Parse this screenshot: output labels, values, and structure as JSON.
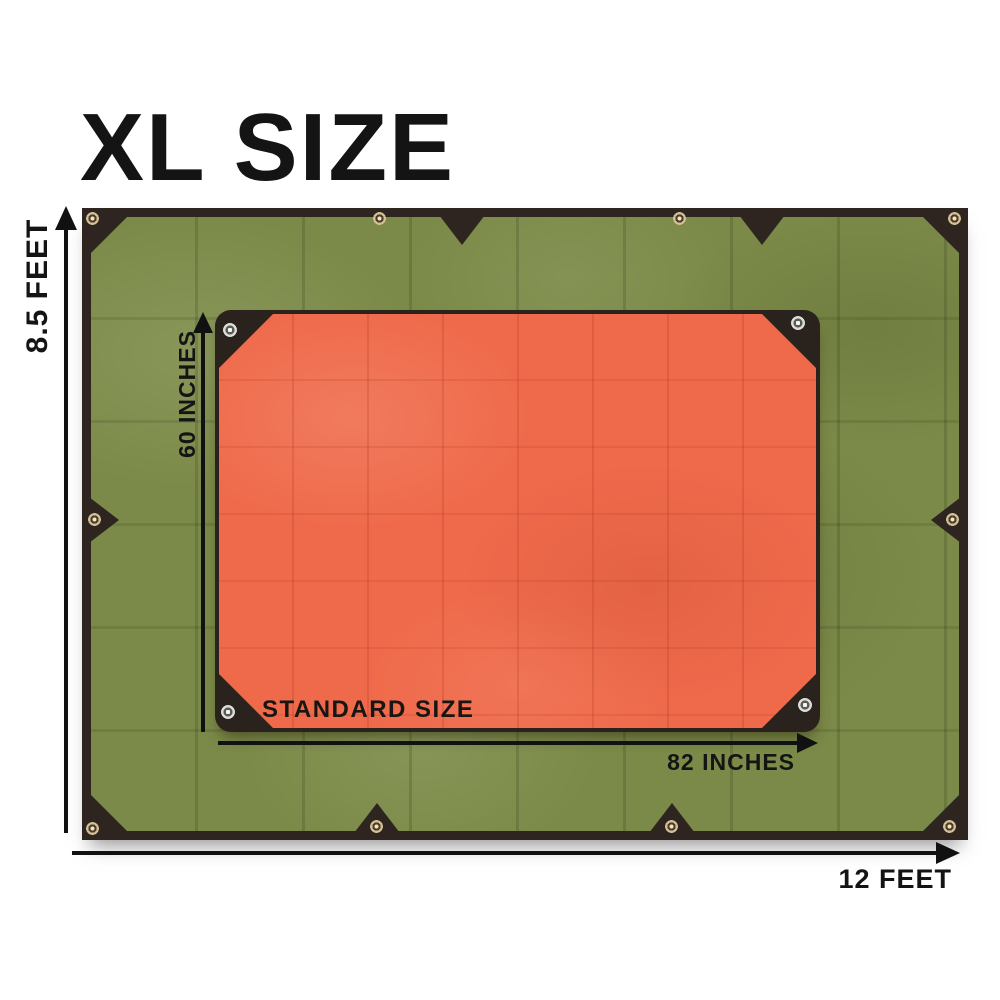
{
  "title": "XL SIZE",
  "xl_tarp": {
    "height_label": "8.5 FEET",
    "width_label": "12 FEET"
  },
  "standard_tarp": {
    "name_label": "STANDARD SIZE",
    "height_label": "60 INCHES",
    "width_label": "82 INCHES"
  },
  "colors": {
    "background": "#ffffff",
    "text": "#141414",
    "xl_tarp_green": "#7b8a48",
    "tarp_trim_dark": "#2e2520",
    "standard_tarp_orange": "#ef6a4b",
    "standard_trim_dark": "#2a221d",
    "grommet_brass": "#d5c195",
    "grommet_silver": "#dcdcd8"
  }
}
